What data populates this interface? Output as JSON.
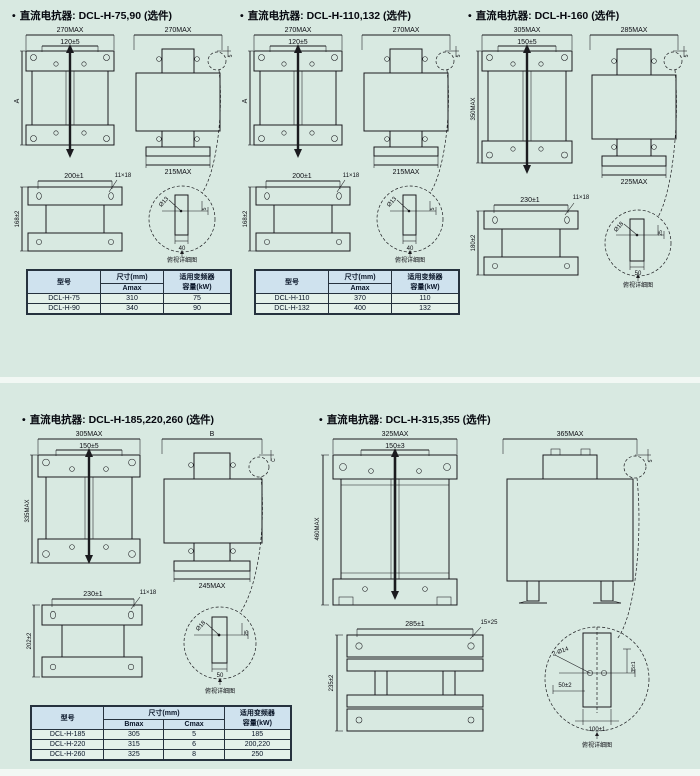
{
  "page": {
    "bg": "#d8e9e1",
    "band": "#f2f8f4"
  },
  "table_labels": {
    "model": "型号",
    "dim": "尺寸(mm)",
    "cap1": "适用变频器",
    "cap2": "容量(kW)"
  },
  "sections": [
    {
      "bullet": "•",
      "title": "直流电抗器: DCL-H-75,90 (选件)",
      "front": {
        "w": "270MAX",
        "inner": "120±5",
        "h": "A"
      },
      "side": {
        "w": "270MAX",
        "base": "215MAX",
        "t": "5"
      },
      "bottom": {
        "w": "200±1",
        "slot": "11×18",
        "h": "168±2"
      },
      "detail": {
        "hole": "Ø13",
        "w": "40",
        "t": "5",
        "label": "俯视详细图"
      },
      "table": {
        "sub1": "Amax",
        "rows": [
          {
            "model": "DCL-H-75",
            "v1": "310",
            "cap": "75"
          },
          {
            "model": "DCL-H-90",
            "v1": "340",
            "cap": "90"
          }
        ]
      }
    },
    {
      "bullet": "•",
      "title": "直流电抗器: DCL-H-110,132 (选件)",
      "front": {
        "w": "270MAX",
        "inner": "120±5",
        "h": "A"
      },
      "side": {
        "w": "270MAX",
        "base": "215MAX",
        "t": "5"
      },
      "bottom": {
        "w": "200±1",
        "slot": "11×18",
        "h": "168±2"
      },
      "detail": {
        "hole": "Ø13",
        "w": "40",
        "t": "5",
        "label": "俯视详细图"
      },
      "table": {
        "sub1": "Amax",
        "rows": [
          {
            "model": "DCL-H-110",
            "v1": "370",
            "cap": "110"
          },
          {
            "model": "DCL-H-132",
            "v1": "400",
            "cap": "132"
          }
        ]
      }
    },
    {
      "bullet": "•",
      "title": "直流电抗器: DCL-H-160 (选件)",
      "front": {
        "w": "305MAX",
        "inner": "150±5",
        "h": "350MAX"
      },
      "side": {
        "w": "285MAX",
        "base": "225MAX",
        "t": "5"
      },
      "bottom": {
        "w": "230±1",
        "slot": "11×18",
        "h": "180±2"
      },
      "detail": {
        "hole": "Ø18",
        "w": "50",
        "t": "25",
        "label": "俯视详细图"
      }
    },
    {
      "bullet": "•",
      "title": "直流电抗器: DCL-H-185,220,260 (选件)",
      "front": {
        "w": "305MAX",
        "inner": "150±5",
        "h": "335MAX"
      },
      "side": {
        "w": "B",
        "base": "245MAX",
        "t": "C"
      },
      "bottom": {
        "w": "230±1",
        "slot": "11×18",
        "h": "202±2"
      },
      "detail": {
        "hole": "Ø18",
        "w": "50",
        "t": "25",
        "label": "俯视详细图"
      },
      "table": {
        "sub1": "Bmax",
        "sub2": "Cmax",
        "rows": [
          {
            "model": "DCL-H-185",
            "v1": "305",
            "v2": "5",
            "cap": "185"
          },
          {
            "model": "DCL-H-220",
            "v1": "315",
            "v2": "6",
            "cap": "200,220"
          },
          {
            "model": "DCL-H-260",
            "v1": "325",
            "v2": "8",
            "cap": "250"
          }
        ]
      }
    },
    {
      "bullet": "•",
      "title": "直流电抗器: DCL-H-315,355 (选件)",
      "front": {
        "w": "325MAX",
        "inner": "150±3",
        "h": "460MAX"
      },
      "side": {
        "w": "365MAX",
        "t": "5"
      },
      "bottom": {
        "w": "285±1",
        "slot": "15×25",
        "h": "235±2"
      },
      "detail": {
        "holes": "2-Ø14",
        "a": "50±2",
        "b": "100±1",
        "c": "35±1",
        "label": "俯视详细图"
      }
    }
  ]
}
